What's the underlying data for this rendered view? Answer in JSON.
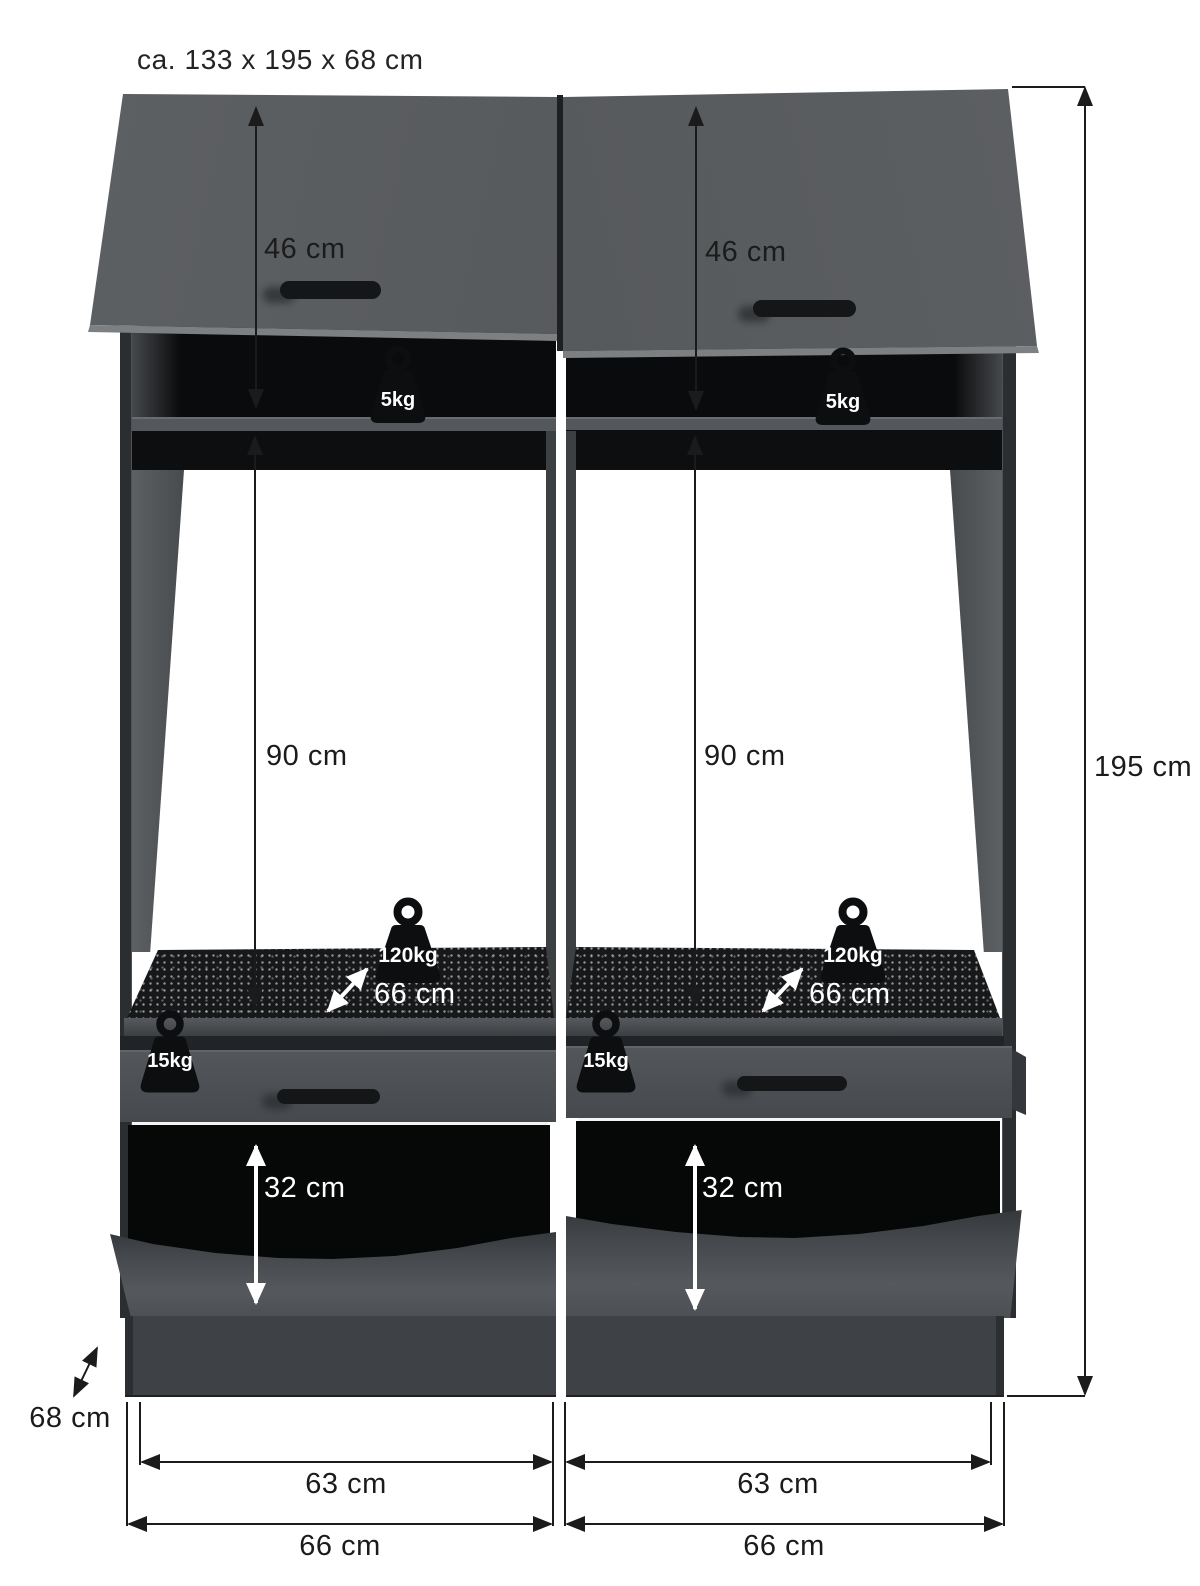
{
  "title": "ca. 133 x 195 x 68 cm",
  "overall": {
    "height": "195 cm",
    "depth": "68 cm"
  },
  "units": {
    "left": {
      "door_height": "46 cm",
      "top_shelf_load": "5kg",
      "opening_height": "90 cm",
      "shelf_load": "120kg",
      "shelf_depth": "66 cm",
      "drawer_load": "15kg",
      "niche_height": "32 cm",
      "inner_width": "63 cm",
      "outer_width": "66 cm"
    },
    "right": {
      "door_height": "46 cm",
      "top_shelf_load": "5kg",
      "opening_height": "90 cm",
      "shelf_load": "120kg",
      "shelf_depth": "66 cm",
      "drawer_load": "15kg",
      "niche_height": "32 cm",
      "inner_width": "63 cm",
      "outer_width": "66 cm"
    }
  },
  "colors": {
    "cabinet_front": "#55585b",
    "cabinet_side": "#2b2e31",
    "interior_dark": "#0a0b0c",
    "mat_dark": "#17181a",
    "dimension_black": "#1b1b1b",
    "dimension_white": "#ffffff",
    "background": "#ffffff"
  }
}
